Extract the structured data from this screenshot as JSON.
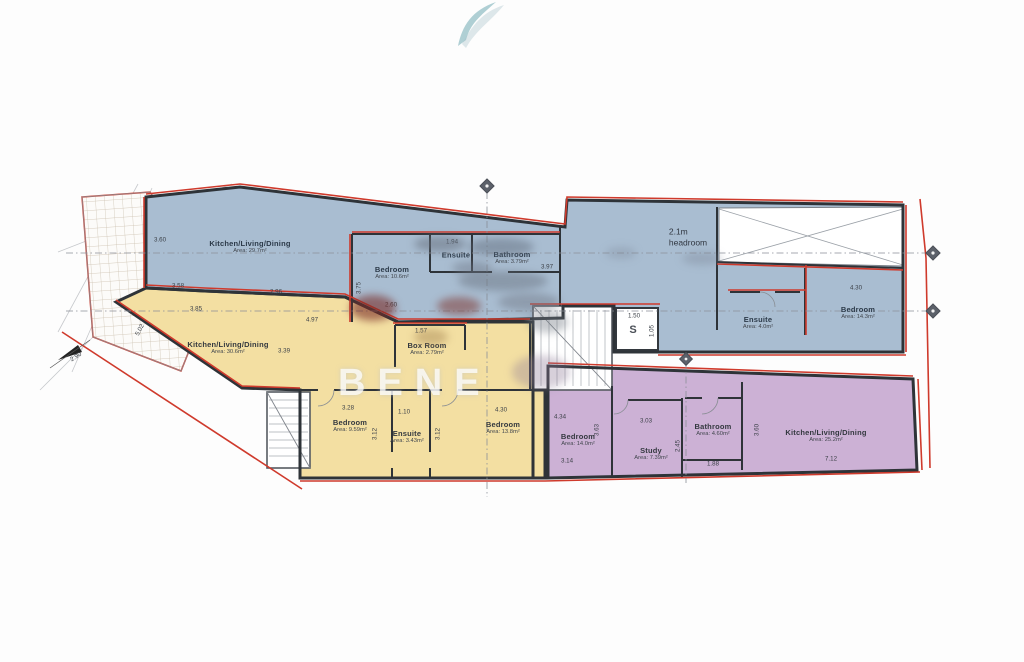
{
  "watermark": {
    "brand_text": "BENE"
  },
  "palette": {
    "flat_blue": "#a9bdd1",
    "flat_yellow": "#f3dfa2",
    "flat_purple": "#ccb1d5",
    "wall": "#2e3338",
    "boundary_red": "#cf3a2c"
  },
  "flats": {
    "blue": {
      "kitchen_living_dining": {
        "name": "Kitchen/Living/Dining",
        "area": "Area: 29.7m²"
      },
      "bedroom_left": {
        "name": "Bedroom",
        "area": "Area: 10.6m²"
      },
      "ensuite_left": {
        "name": "Ensuite"
      },
      "shower_mid": {
        "name": "Bathroom",
        "area": "Area: 3.79m²"
      },
      "ensuite_right": {
        "name": "Ensuite",
        "area": "Area: 4.0m²"
      },
      "bedroom_right": {
        "name": "Bedroom",
        "area": "Area: 14.3m²"
      },
      "headroom_line1": "2.1m",
      "headroom_line2": "headroom",
      "shaft_label": "S"
    },
    "yellow": {
      "kitchen_living_dining": {
        "name": "Kitchen/Living/Dining",
        "area": "Area: 30.6m²"
      },
      "box_room": {
        "name": "Box Room",
        "area": "Area: 2.79m²"
      },
      "bedroom_one": {
        "name": "Bedroom",
        "area": "Area: 9.59m²"
      },
      "ensuite": {
        "name": "Ensuite",
        "area": "Area: 3.43m²"
      },
      "bedroom_two": {
        "name": "Bedroom",
        "area": "Area: 13.8m²"
      }
    },
    "purple": {
      "bedroom": {
        "name": "Bedroom",
        "area": "Area: 14.0m²"
      },
      "study": {
        "name": "Study",
        "area": "Area: 7.39m²"
      },
      "bathroom": {
        "name": "Bathroom",
        "area": "Area: 4.60m²"
      },
      "kitchen_living_dining": {
        "name": "Kitchen/Living/Dining",
        "area": "Area: 25.2m²"
      }
    }
  },
  "dimensions": {
    "blue_kld_height": "3.60",
    "blue_kld_width_a": "3.58",
    "blue_kld_width_b": "2.96",
    "blue_bedroom_height": "3.75",
    "blue_bedroom_width": "2.60",
    "blue_ensuite_width": "1.94",
    "blue_mid_width": "3.97",
    "blue_bedroom_right_width": "4.30",
    "shaft_width": "1.50",
    "shaft_depth": "1.05",
    "yellow_kld_height": "5.02",
    "yellow_kld_width_a": "3.85",
    "yellow_kld_width_b": "4.97",
    "yellow_kld_width_c": "3.39",
    "box_room_width": "1.57",
    "yellow_bedroom_one_width": "3.28",
    "yellow_bedroom_one_height": "3.12",
    "yellow_ensuite_width": "1.10",
    "yellow_bedroom_two_height": "3.12",
    "yellow_bedroom_two_width": "4.30",
    "purple_bedroom_width": "4.34",
    "purple_bedroom_height": "3.63",
    "purple_bedroom_base": "3.14",
    "study_width": "3.03",
    "study_height": "2.45",
    "bathroom_width": "1.88",
    "purple_kld_height": "3.60",
    "purple_kld_width": "7.12",
    "site_edge": "2.90"
  }
}
